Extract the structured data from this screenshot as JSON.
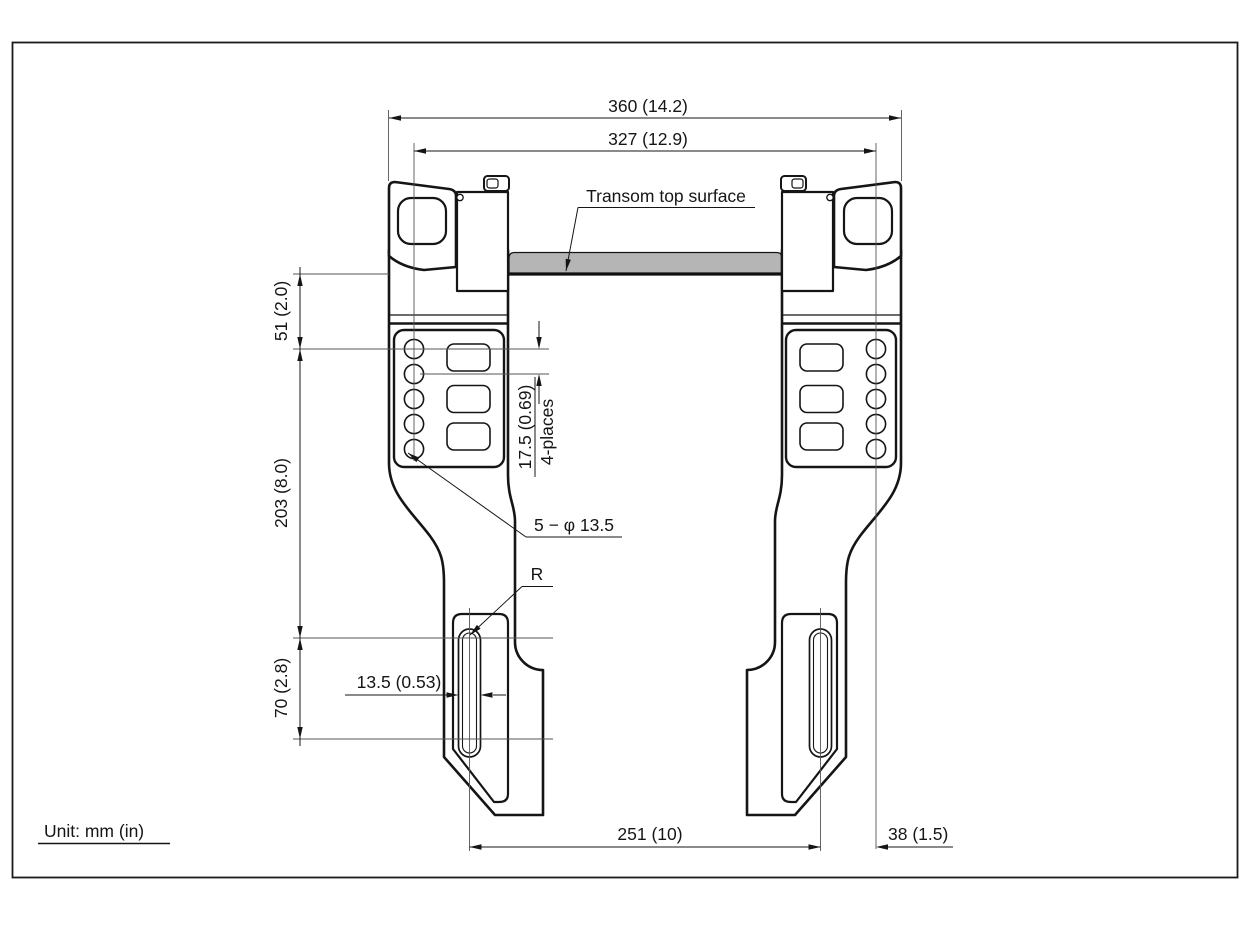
{
  "drawing": {
    "unit_label": "Unit: mm (in)",
    "labels": {
      "transom_surface": "Transom top surface",
      "hole_callout": "5 − φ 13.5",
      "radius_callout": "R",
      "hole_pitch": "17.5 (0.69)",
      "hole_pitch_places": "4-places"
    },
    "dimensions": {
      "overall_width": "360 (14.2)",
      "mount_hole_span": "327 (12.9)",
      "transom_to_first_hole": "51 (2.0)",
      "bracket_drop": "203 (8.0)",
      "slot_length": "70 (2.8)",
      "slot_width": "13.5 (0.53)",
      "foot_slot_span": "251 (10)",
      "foot_to_hole_line": "38 (1.5)"
    },
    "colors": {
      "transom_fill": "#b5b5b5",
      "line": "#151515"
    }
  }
}
